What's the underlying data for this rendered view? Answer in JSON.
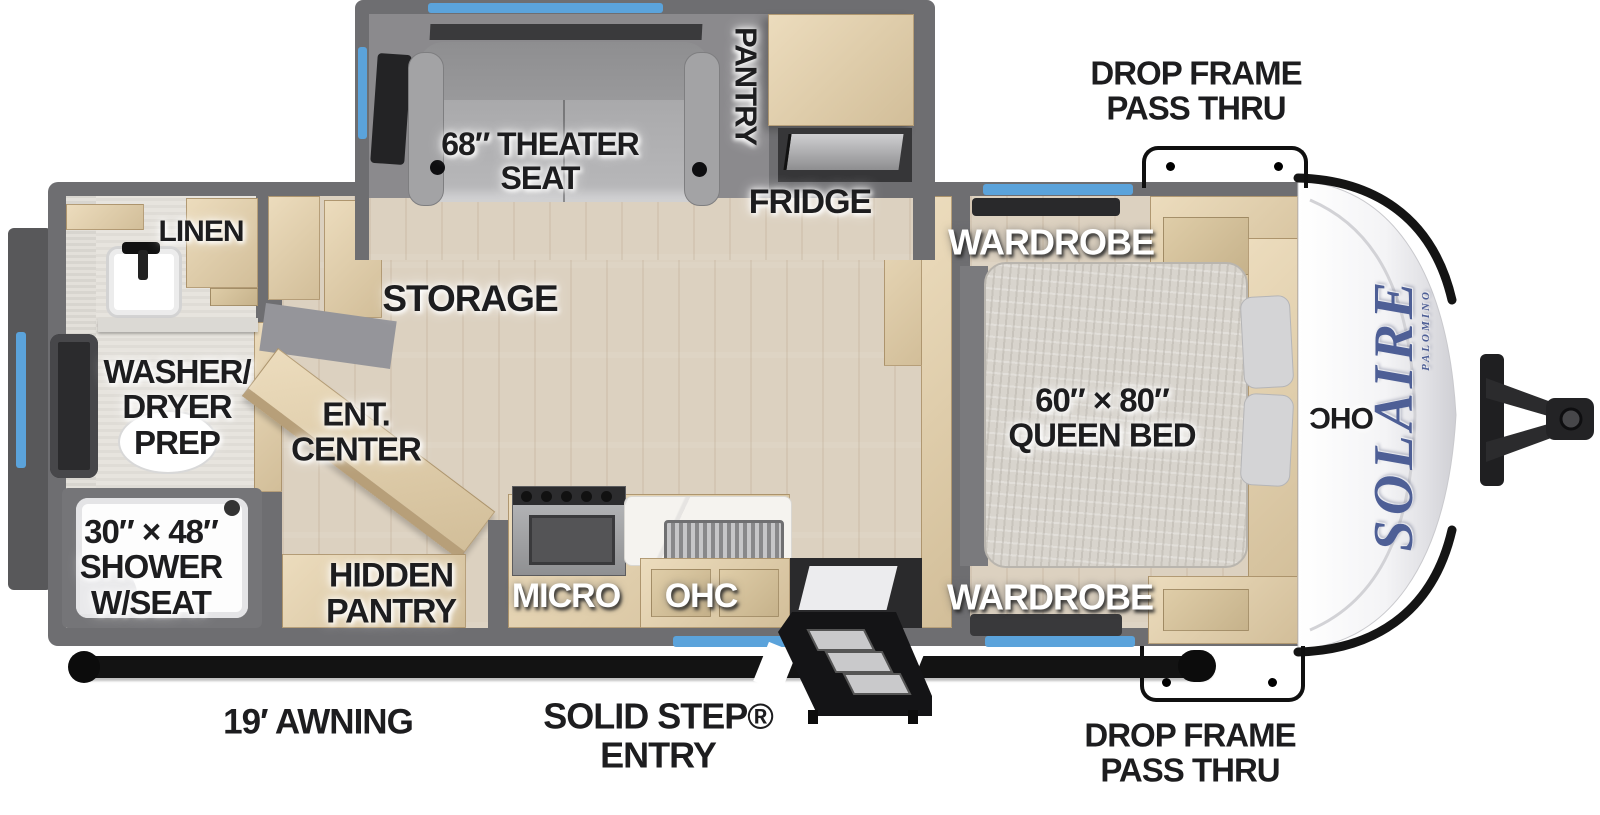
{
  "diagram_title": "Solaire travel trailer floorplan",
  "labels": {
    "drop_frame_top": "DROP FRAME\nPASS THRU",
    "drop_frame_bottom": "DROP FRAME\nPASS THRU",
    "theater_seat": "68″ THEATER\nSEAT",
    "pantry": "PANTRY",
    "fridge": "FRIDGE",
    "storage": "STORAGE",
    "linen": "LINEN",
    "washer_dryer": "WASHER/\nDRYER\nPREP",
    "ent_center": "ENT.\nCENTER",
    "shower": "30″ × 48″\nSHOWER\nW/SEAT",
    "hidden_pantry": "HIDDEN\nPANTRY",
    "micro": "MICRO",
    "ohc_kitchen": "OHC",
    "wardrobe_top": "WARDROBE",
    "wardrobe_bottom": "WARDROBE",
    "queen_bed": "60″ × 80″\nQUEEN BED",
    "ohc_front": "OHC",
    "awning": "19′ AWNING",
    "solid_step": "SOLID STEP®\nENTRY",
    "logo": "SOLAIRE",
    "logo_sub": "PALOMINO"
  },
  "colors": {
    "wall": "#6e6e71",
    "wall_dark": "#58585a",
    "floor": "#dcd1c0",
    "floor_bath": "#e7e4de",
    "window_blue": "#5ba3db",
    "ink": "#1d1d1f",
    "logo_blue": "#4e5f96",
    "accent_black": "#131313"
  }
}
